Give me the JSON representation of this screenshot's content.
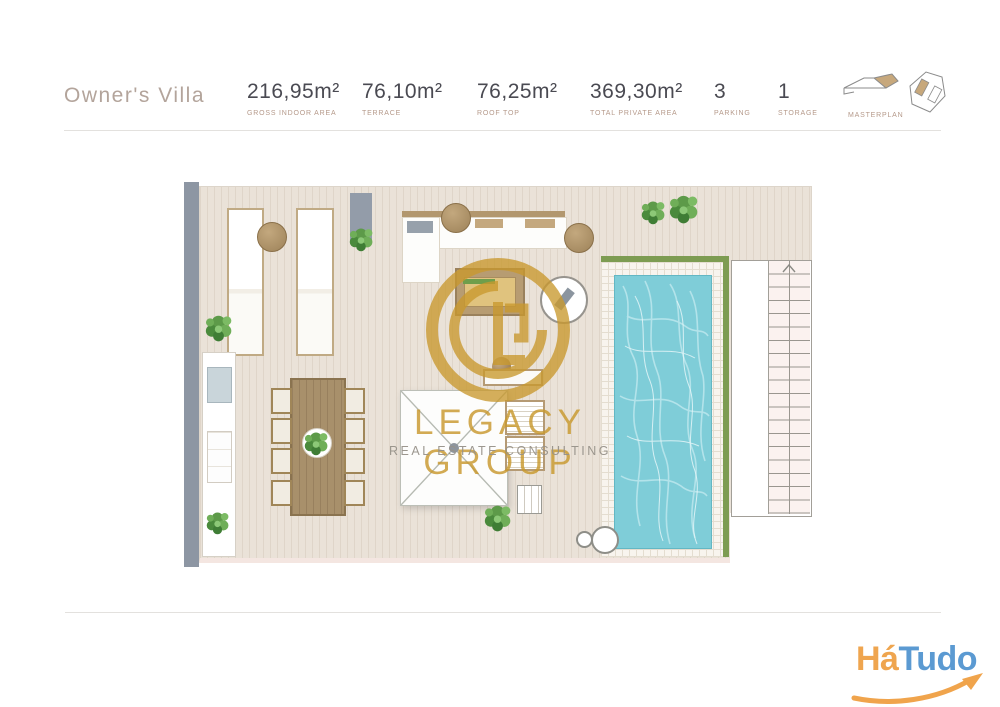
{
  "header": {
    "title": "Owner's Villa",
    "specs": [
      {
        "value": "216,95m²",
        "label": "GROSS INDOOR AREA"
      },
      {
        "value": "76,10m²",
        "label": "TERRACE"
      },
      {
        "value": "76,25m²",
        "label": "ROOF TOP"
      },
      {
        "value": "369,30m²",
        "label": "TOTAL PRIVATE AREA"
      },
      {
        "value": "3",
        "label": "PARKING"
      },
      {
        "value": "1",
        "label": "STORAGE"
      }
    ],
    "masterplan_label": "MASTERPLAN"
  },
  "watermark": {
    "brand": "LEGACY GROUP",
    "tagline": "REAL ESTATE CONSULTING",
    "gold": "#C9992E"
  },
  "brand_footer": {
    "name_part1": "Há",
    "name_part2": "Tudo",
    "part1_color": "#EFA54F",
    "part2_color": "#5B9AD2",
    "swoosh_color": "#F0A44C"
  },
  "floorplan": {
    "deck_color": "#EAE2D8",
    "wall_color": "#8D96A3",
    "pool_water_color": "#7FCDD8",
    "pool_edge_color": "#7D9C52",
    "icons": [
      "plant-icon",
      "pool-icon",
      "stairs-up-icon",
      "pergola-icon",
      "masterplan-icon"
    ]
  }
}
